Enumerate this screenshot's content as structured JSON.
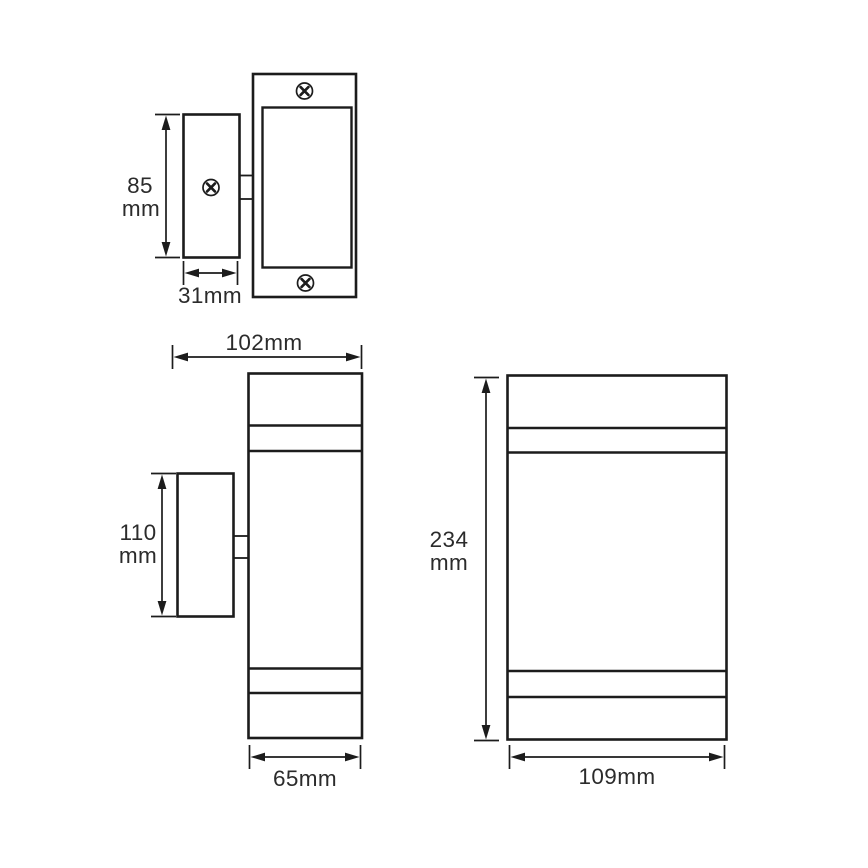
{
  "colors": {
    "line": "#1c1c1c",
    "text": "#2b2b2b",
    "background": "#ffffff"
  },
  "dimensions": {
    "plan_bracket_height": {
      "line1": "85",
      "line2": "mm"
    },
    "plan_bracket_depth": "31mm",
    "side_overall_depth": "102mm",
    "side_bracket_height": {
      "line1": "110",
      "line2": "mm"
    },
    "side_body_width": "65mm",
    "front_overall_height": {
      "line1": "234",
      "line2": "mm"
    },
    "front_overall_width": "109mm"
  },
  "measurements_mm": {
    "plan_bracket_height": 85,
    "plan_bracket_depth": 31,
    "side_overall_depth": 102,
    "side_bracket_height": 110,
    "side_body_width": 65,
    "front_overall_height": 234,
    "front_overall_width": 109
  },
  "icons": {
    "screw": "phillips-screw-head"
  }
}
